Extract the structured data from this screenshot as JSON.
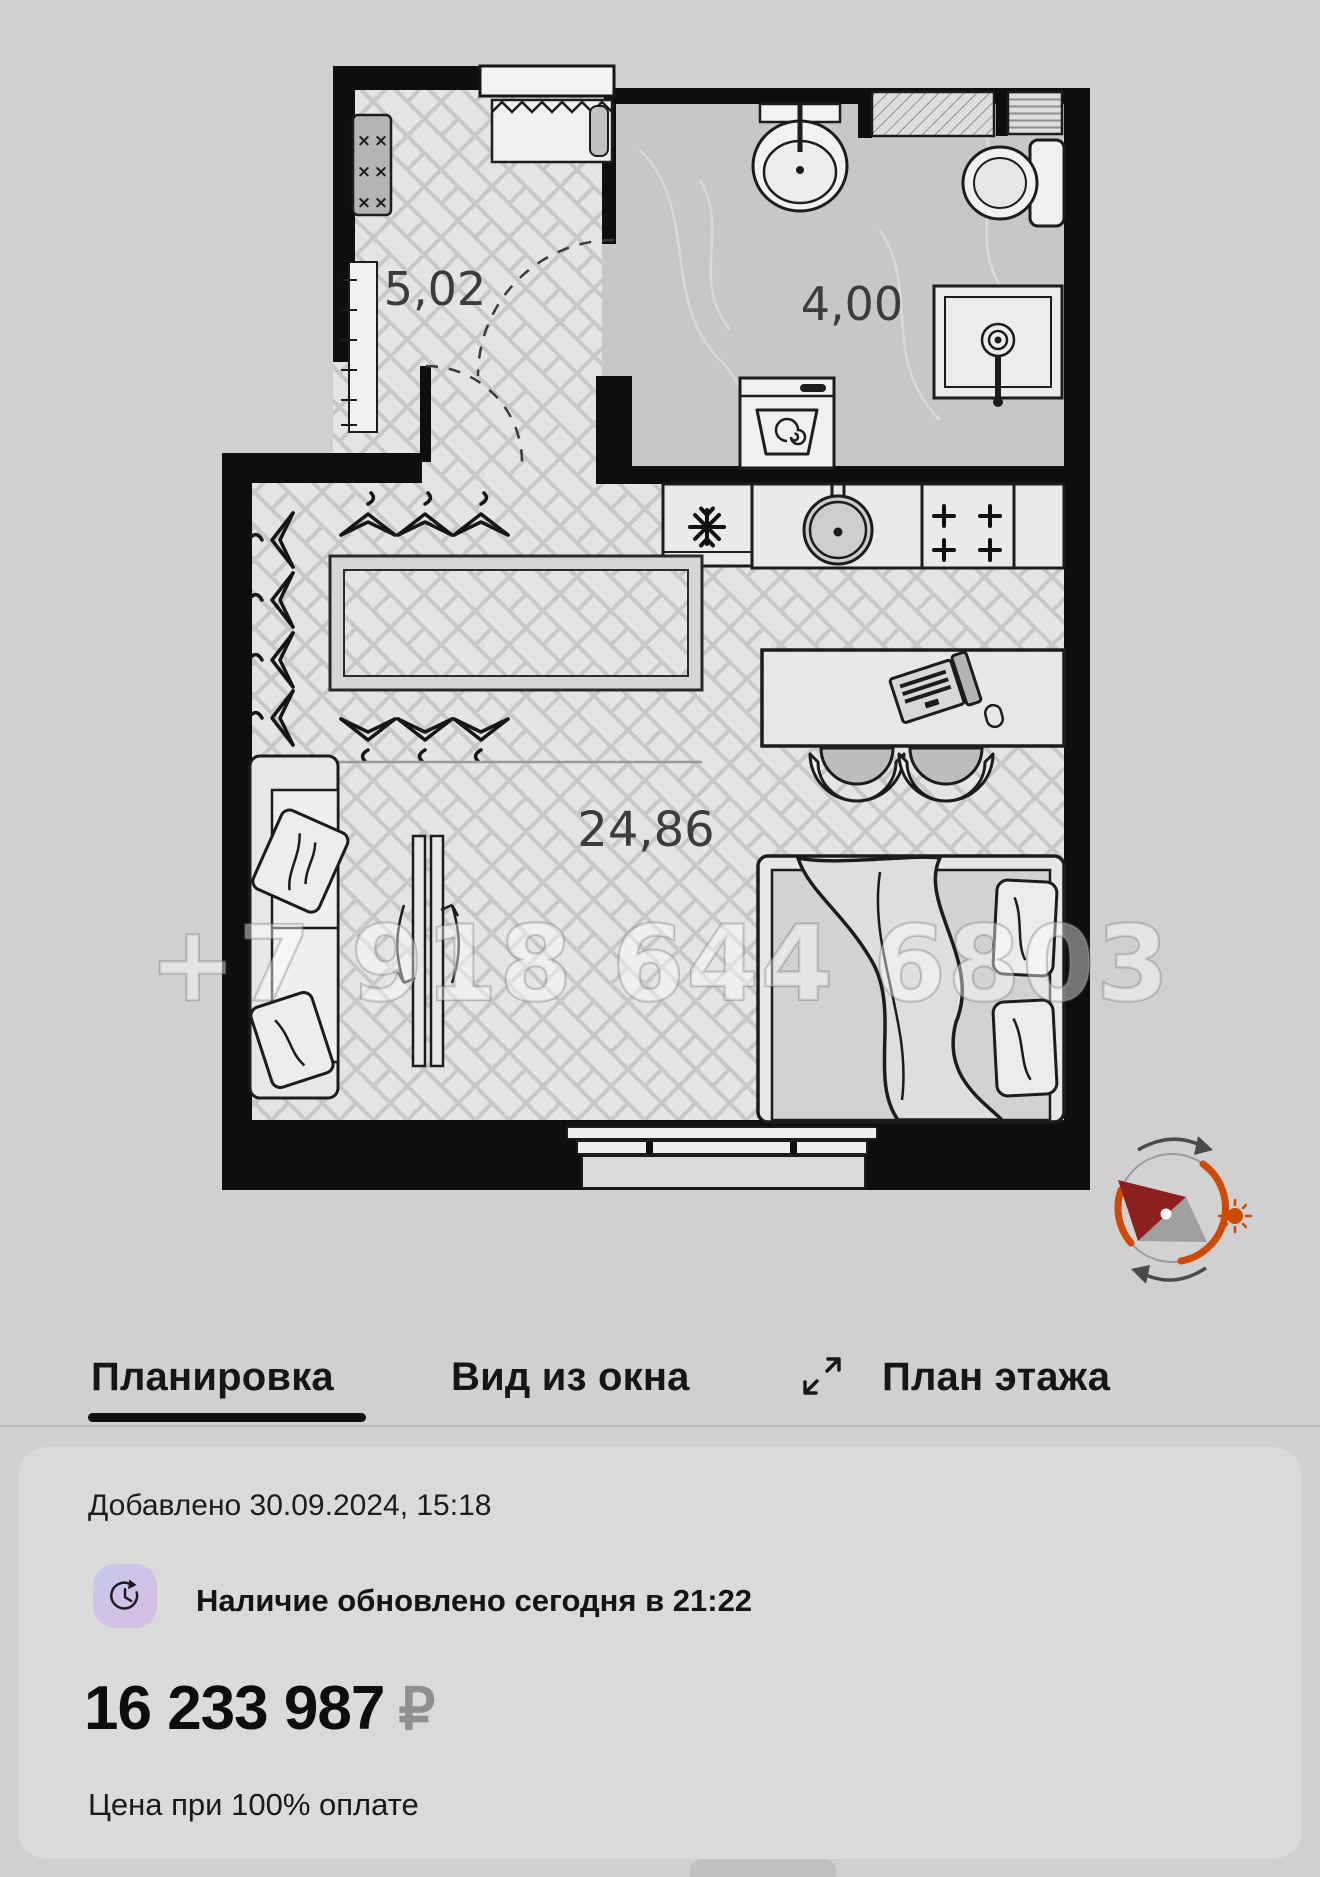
{
  "floor_plan": {
    "labels": {
      "hallway_area": "5,02",
      "bathroom_area": "4,00",
      "living_area": "24,86"
    },
    "watermark": "+7 918 644 6803"
  },
  "tabs": {
    "layout": "Планировка",
    "window_view": "Вид из окна",
    "floor_plan": "План этажа"
  },
  "card": {
    "added": "Добавлено 30.09.2024, 15:18",
    "availability": "Наличие обновлено сегодня в 21:22",
    "price": "16 233 987",
    "currency": "₽",
    "note": "Цена при 100% оплате"
  },
  "colors": {
    "accent_orange": "#cf4a04",
    "needle_red": "#8e1f1f",
    "wall_black": "#0e0e0e",
    "page_bg": "#d0d0d0"
  }
}
